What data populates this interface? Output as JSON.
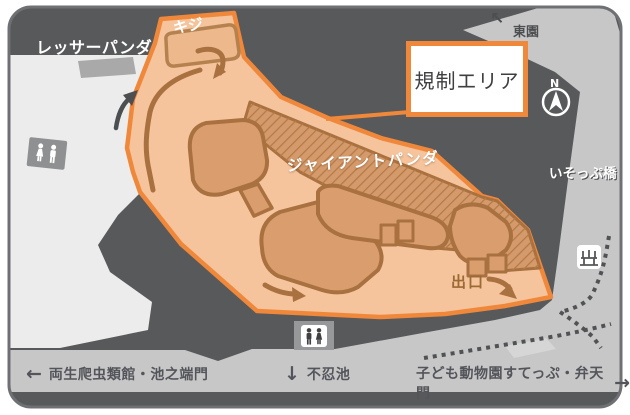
{
  "colors": {
    "map_bg": "#58595b",
    "path_gray": "#c7c7c8",
    "walkway_light": "#ececec",
    "restricted_border": "#f0883b",
    "restricted_fill": "#f5c49c",
    "enclosure_fill": "#d99d6e",
    "enclosure_outline": "#a9713f",
    "hatch_stripe": "#b57b46",
    "label_dark": "#54555a",
    "exit_text": "#9c6a33"
  },
  "areas": {
    "red_panda": {
      "label": "レッサーパンダ"
    },
    "pheasant": {
      "label": "キジ"
    },
    "giant_panda": {
      "label": "ジャイアントパンダ"
    }
  },
  "callout": {
    "label": "規制エリア"
  },
  "compass": {
    "north": "N"
  },
  "signs": {
    "east_garden": {
      "arrow": "↖",
      "label": "東園"
    },
    "isopp_bridge": {
      "label": "いそっぷ橋"
    },
    "exit": {
      "label": "出口"
    },
    "reptile_house_gate": {
      "arrow": "←",
      "label": "両生爬虫類館・池之端門"
    },
    "shinobazu_pond": {
      "arrow": "↓",
      "label": "不忍池"
    },
    "childrens_zoo_gate": {
      "label": "子ども動物園すてっぷ・弁天門",
      "arrow": "→"
    }
  }
}
